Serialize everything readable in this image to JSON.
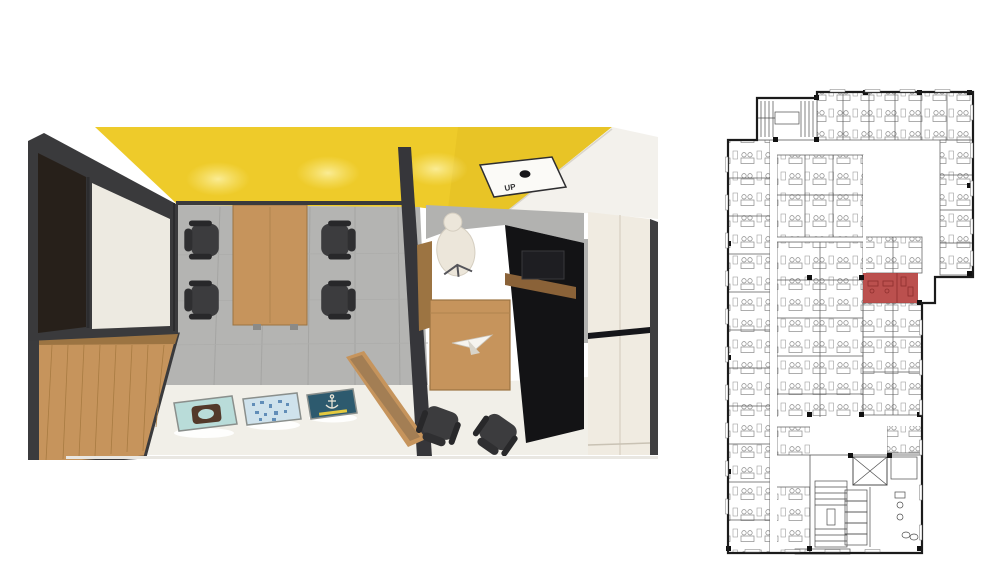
{
  "figures": {
    "render": {
      "name": "interior-render-top-view",
      "ceiling_sign_text": "UP",
      "colors": {
        "ceiling_yellow": "#eecb2a",
        "ceiling_glow": "#f9e77d",
        "wall_frame_dark": "#3a3a3c",
        "wood": "#c6945c",
        "wood_dark": "#9c7442",
        "floor_gray": "#b4b4b2",
        "floor_cream": "#f1efe8",
        "panel_cream": "#f0ebe1",
        "black_unit": "#131315",
        "exec_chair_white": "#ece6da"
      },
      "artworks": [
        {
          "name": "artwork-emblem",
          "bg": "#b9dcd9",
          "accent": "#53392a"
        },
        {
          "name": "artwork-blue-pattern",
          "bg": "#cfe2ec",
          "accent": "#4e7fb0"
        },
        {
          "name": "artwork-anchor",
          "bg": "#2d5a6e",
          "accent": "#e9e5d8",
          "stripe": "#e3c93f"
        }
      ]
    },
    "floorplan": {
      "name": "office-floor-plan",
      "wall_color": "#1b1b1b",
      "line_color": "#5a5a5a",
      "highlight_color": "#b5413f"
    }
  }
}
